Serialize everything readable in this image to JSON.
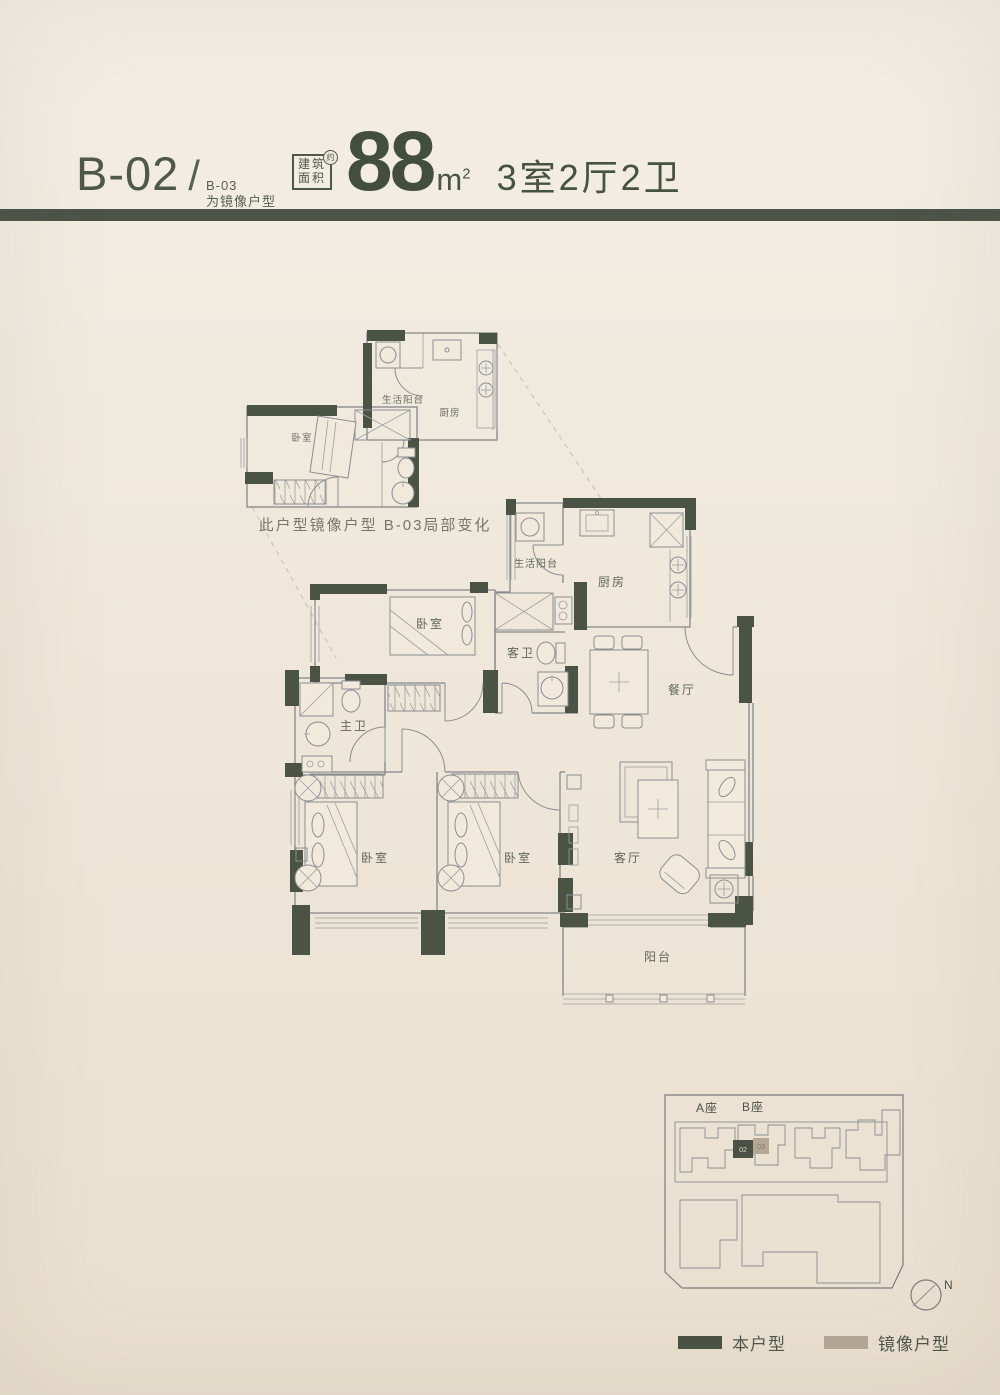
{
  "header": {
    "unit_code": "B-02",
    "separator": "/",
    "mirror_code": "B-03",
    "mirror_note": "为镜像户型",
    "stamp_line1": "建筑",
    "stamp_line2": "面积",
    "stamp_approx": "约",
    "area_value": "88",
    "area_unit": "m",
    "area_exponent": "2",
    "layout_text": "3室2厅2卫"
  },
  "inset_plan": {
    "caption": "此户型镜像户型 B-03局部变化",
    "rooms": {
      "service_balcony": "生活阳台",
      "kitchen": "厨房",
      "bedroom": "卧室"
    }
  },
  "main_plan": {
    "rooms": {
      "service_balcony": "生活阳台",
      "kitchen": "厨房",
      "bedroom_top": "卧室",
      "guest_bath": "客卫",
      "dining": "餐厅",
      "master_bath": "主卫",
      "bedroom_left": "卧室",
      "bedroom_middle": "卧室",
      "living": "客厅",
      "balcony": "阳台"
    }
  },
  "site_plan": {
    "tower_a": "A座",
    "tower_b": "B座",
    "unit_this": "02",
    "unit_mirror": "03",
    "north_label": "N"
  },
  "legend": {
    "this_unit_label": "本户型",
    "this_unit_color": "#4a5245",
    "mirror_unit_label": "镜像户型",
    "mirror_unit_color": "#b4a796"
  },
  "colors": {
    "wall": "#4b5345",
    "divider": "#4c5349",
    "accent_text": "#48533f"
  }
}
